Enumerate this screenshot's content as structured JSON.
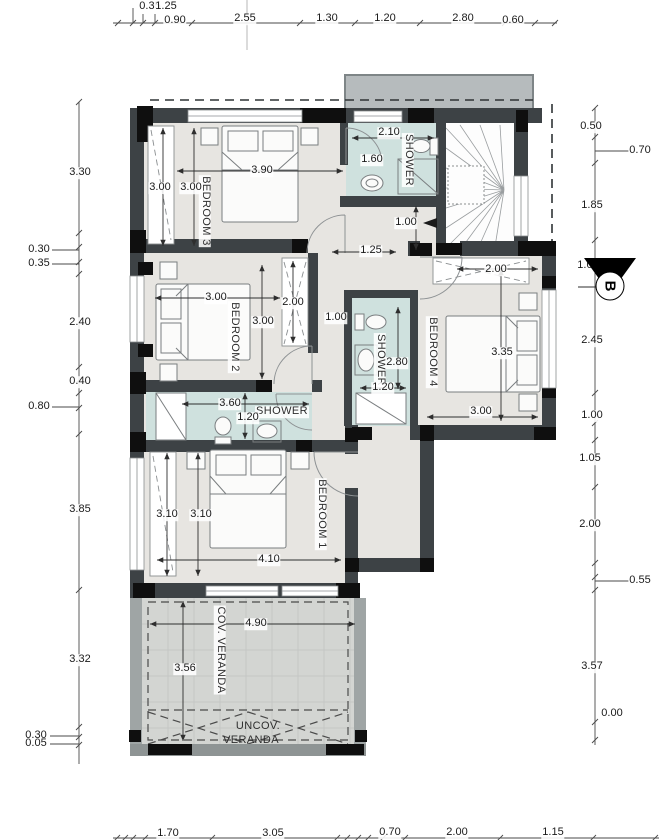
{
  "plan": {
    "rooms": {
      "bedroom1": {
        "label": "BEDROOM 1"
      },
      "bedroom2": {
        "label": "BEDROOM 2"
      },
      "bedroom3": {
        "label": "BEDROOM 3"
      },
      "bedroom4": {
        "label": "BEDROOM 4"
      },
      "shower_top": {
        "label": "SHOWER"
      },
      "shower_mid": {
        "label": "SHOWER"
      },
      "shower_bottom": {
        "label": "SHOWER"
      },
      "cov_veranda": {
        "label": "COV. VERANDA"
      },
      "uncov_veranda": {
        "line1": "UNCOV.",
        "line2": "VERANDA"
      }
    },
    "section_marker": {
      "label": "B"
    },
    "dimensions": {
      "top": [
        "0.35",
        "1.25",
        "0.90",
        "2.55",
        "1.30",
        "1.20",
        "2.80",
        "0.60"
      ],
      "left": [
        "3.30",
        "0.30",
        "0.35",
        "2.40",
        "0.40",
        "0.80",
        "3.85",
        "3.32",
        "0.30",
        "0.05"
      ],
      "right": [
        "0.50",
        "0.70",
        "1.85",
        "1.00",
        "2.45",
        "1.00",
        "1.05",
        "2.00",
        "0.55",
        "3.57",
        "0.00"
      ],
      "bottom": [
        "1.70",
        "3.05",
        "0.70",
        "2.00",
        "1.15"
      ],
      "interior": {
        "bedroom3_width": "3.90",
        "bedroom3_depth_a": "3.00",
        "bedroom3_depth_b": "3.00",
        "shower_top_width": "2.10",
        "shower_top_depth": "1.60",
        "stair_width": "1.00",
        "hall_opening": "1.25",
        "bedroom4_closet_width": "2.00",
        "bedroom2_width": "3.00",
        "bedroom2_closet_depth": "2.00",
        "bedroom2_depth": "3.00",
        "corridor_width": "1.00",
        "shower_mid_depth": "2.80",
        "shower_mid_width": "1.20",
        "bedroom4_depth": "3.35",
        "bedroom4_width": "3.00",
        "shower_bottom_width": "3.60",
        "shower_bottom_depth": "1.20",
        "bedroom1_depth_a": "3.10",
        "bedroom1_depth_b": "3.10",
        "bedroom1_width": "4.10",
        "veranda_width": "4.90",
        "veranda_depth": "3.56"
      }
    },
    "colors": {
      "wall": "#3d4245",
      "lintel": "#0f0f0f",
      "floor": "#e7e5e1",
      "shower_floor": "#cfe1de",
      "veranda_floor": "#d3d5d2",
      "overhang": "#b6bbbd"
    }
  }
}
